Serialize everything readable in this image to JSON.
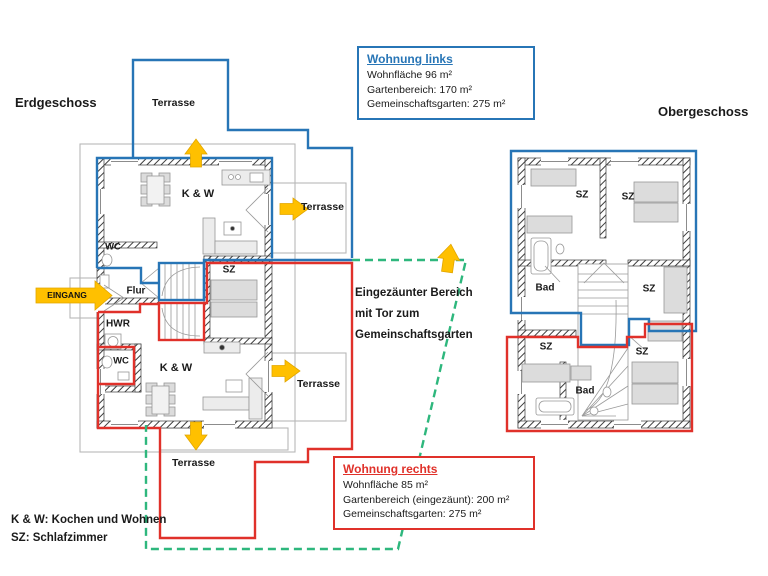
{
  "headers": {
    "ground_floor": "Erdgeschoss",
    "upper_floor": "Obergeschoss"
  },
  "labels": {
    "terrace": "Terrasse",
    "entrance": "EINGANG"
  },
  "info_left": {
    "title": "Wohnung links",
    "lines": [
      "Wohnfläche 96 m²",
      "Gartenbereich: 170 m²",
      "Gemeinschaftsgarten: 275 m²"
    ]
  },
  "info_right": {
    "title": "Wohnung rechts",
    "lines": [
      "Wohnfläche 85 m²",
      "Gartenbereich (eingezäunt): 200 m²",
      "Gemeinschaftsgarten: 275 m²"
    ]
  },
  "fence_note": {
    "line1": "Eingezäunter Bereich",
    "line2": "mit Tor zum",
    "line3": "Gemeinschaftsgarten"
  },
  "legend": {
    "kw": "K & W: Kochen und Wohnen",
    "sz": "SZ: Schlafzimmer"
  },
  "rooms_ground": {
    "kw_top": "K & W",
    "wc_top": "WC",
    "sz": "SZ",
    "flur": "Flur",
    "hwr": "HWR",
    "wc_bottom": "WC",
    "kw_bottom": "K & W"
  },
  "rooms_upper": {
    "sz_top_left": "SZ",
    "sz_top_right": "SZ",
    "bad_top": "Bad",
    "sz_mid_right": "SZ",
    "sz_bottom_left": "SZ",
    "sz_bottom_right": "SZ",
    "bad_bottom": "Bad"
  },
  "colors": {
    "apartment_left_blue": "#2775b6",
    "apartment_right_red": "#e0312a",
    "fence_green": "#2eb77d",
    "arrow_gold": "#ffc000"
  }
}
